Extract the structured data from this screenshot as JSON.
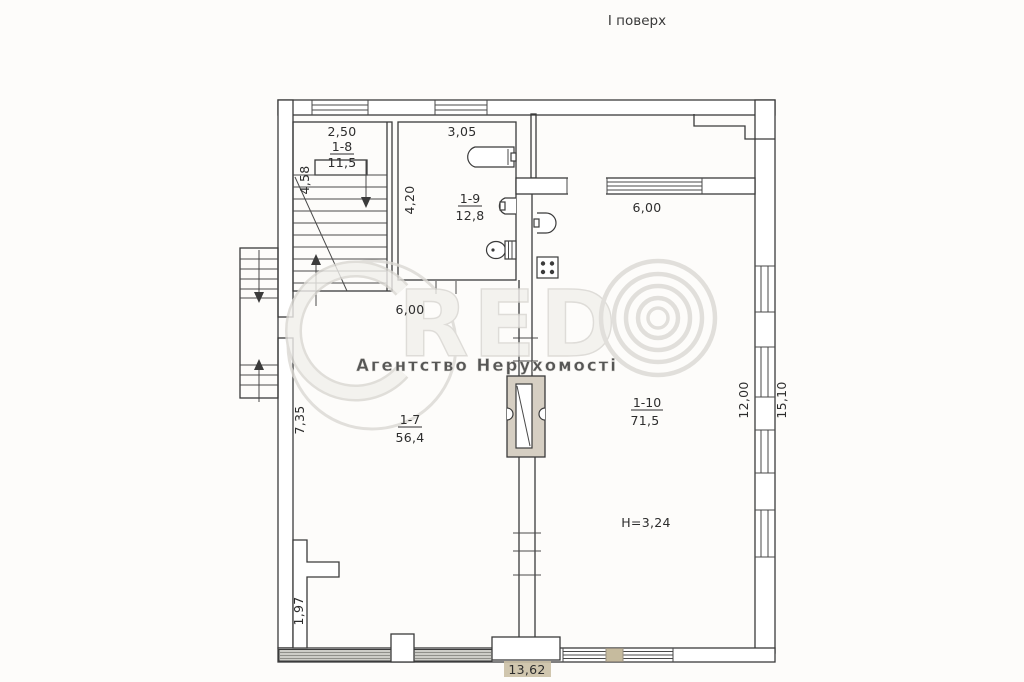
{
  "page": {
    "title": "І поверх"
  },
  "watermark": {
    "brand": "CREDO",
    "brand_red": "RED",
    "subtitle": "Агентство Нерухомості"
  },
  "rooms": {
    "r18": {
      "id": "1-8",
      "area": "11,5",
      "width": "2,50",
      "depth": "4,58"
    },
    "r19": {
      "id": "1-9",
      "area": "12,8",
      "width": "3,05",
      "depth": "4,20"
    },
    "r17": {
      "id": "1-7",
      "area": "56,4",
      "width": "6,00",
      "side": "7,35",
      "side_lower": "1,97"
    },
    "r110": {
      "id": "1-10",
      "area": "71,5",
      "width": "6,00",
      "ceiling": "H=3,24"
    }
  },
  "dims": {
    "right_inner": "12,00",
    "right_outer": "15,10",
    "bottom": "13,62"
  },
  "colors": {
    "line": "#3b3b3b",
    "flue_fill": "#d6cfc3",
    "pier_beige": "#c6bb9e",
    "label_highlight": "#cbc0a5",
    "wall_shade": "#cdcdc8"
  }
}
